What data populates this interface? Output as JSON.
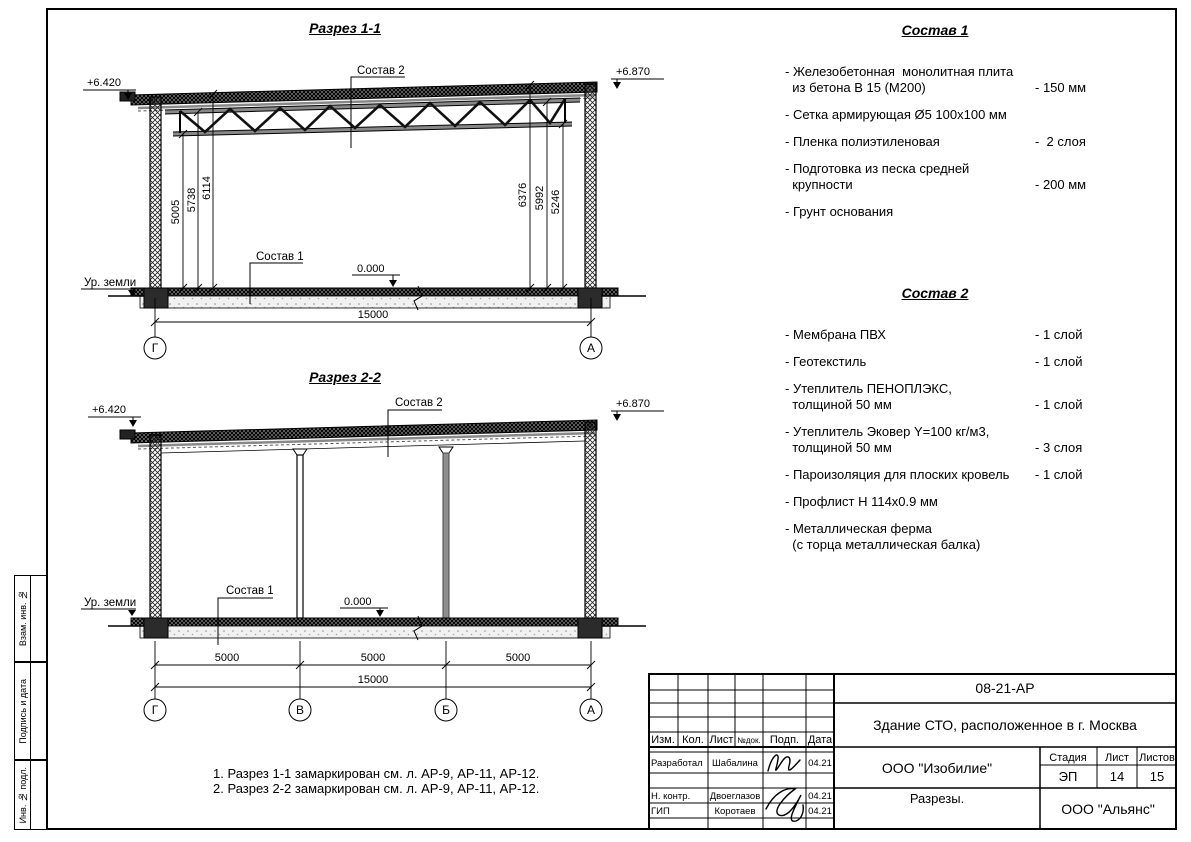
{
  "frame": {
    "labels": [
      "Взам. инв. №",
      "Подпись и дата",
      "Инв. № подл."
    ]
  },
  "labels": {
    "elev_left": "+6.420",
    "elev_right": "+6.870",
    "sostav1": "Состав 1",
    "sostav2": "Состав 2",
    "zero": "0.000",
    "ground": "Ур. земли"
  },
  "section1": {
    "title": "Разрез 1-1",
    "dims_left": [
      "5005",
      "5738",
      "6114"
    ],
    "dims_right": [
      "6376",
      "5992",
      "5246"
    ],
    "dim_total": "15000",
    "axes": [
      "Г",
      "А"
    ]
  },
  "section2": {
    "title": "Разрез 2-2",
    "spans": [
      "5000",
      "5000",
      "5000"
    ],
    "dim_total": "15000",
    "axes": [
      "Г",
      "В",
      "Б",
      "А"
    ]
  },
  "sostav1": {
    "title": "Состав 1",
    "items": [
      {
        "text": "- Железобетонная  монолитная плита\n  из бетона В 15 (М200)",
        "value": "- 150 мм"
      },
      {
        "text": "- Сетка армирующая Ø5 100х100 мм",
        "value": ""
      },
      {
        "text": "- Пленка полиэтиленовая",
        "value": "-  2 слоя"
      },
      {
        "text": "- Подготовка из песка средней\n  крупности",
        "value": "- 200 мм"
      },
      {
        "text": "- Грунт основания",
        "value": ""
      }
    ]
  },
  "sostav2": {
    "title": "Состав 2",
    "items": [
      {
        "text": "- Мембрана ПВХ",
        "value": "- 1 слой"
      },
      {
        "text": "- Геотекстиль",
        "value": "- 1 слой"
      },
      {
        "text": "- Утеплитель ПЕНОПЛЭКС,\n  толщиной 50 мм",
        "value": "- 1 слой"
      },
      {
        "text": "- Утеплитель Эковер Y=100 кг/м3,\n  толщиной 50 мм",
        "value": "- 3 слоя"
      },
      {
        "text": "- Пароизоляция для плоских кровель",
        "value": "- 1 слой"
      },
      {
        "text": "- Профлист Н 114х0.9 мм",
        "value": ""
      },
      {
        "text": "- Металлическая ферма\n  (с торца металлическая балка)",
        "value": ""
      }
    ]
  },
  "notes": {
    "lines": [
      "1. Разрез 1-1 замаркирован см. л. АР-9, АР-11, АР-12.",
      "2. Разрез 2-2 замаркирован см. л. АР-9, АР-11, АР-12."
    ]
  },
  "titleblock": {
    "doc_number": "08-21-АР",
    "object_name": "Здание СТО, расположенное в г. Москва",
    "designer_org": "ООО \"Изобилие\"",
    "sheet_name": "Разрезы.",
    "contractor_org": "ООО \"Альянс\"",
    "stage_label": "Стадия",
    "list_label": "Лист",
    "lists_label": "Листов",
    "stage": "ЭП",
    "list_no": "14",
    "lists_total": "15",
    "cols": [
      "Изм.",
      "Кол.",
      "Лист",
      "№док.",
      "Подп.",
      "Дата"
    ],
    "rows": [
      {
        "role": "Разработал",
        "name": "Шабалина",
        "date": "04.21"
      },
      {
        "role": "Н. контр.",
        "name": "Двоеглазов",
        "date": "04.21"
      },
      {
        "role": "ГИП",
        "name": "Коротаев",
        "date": "04.21"
      }
    ]
  }
}
